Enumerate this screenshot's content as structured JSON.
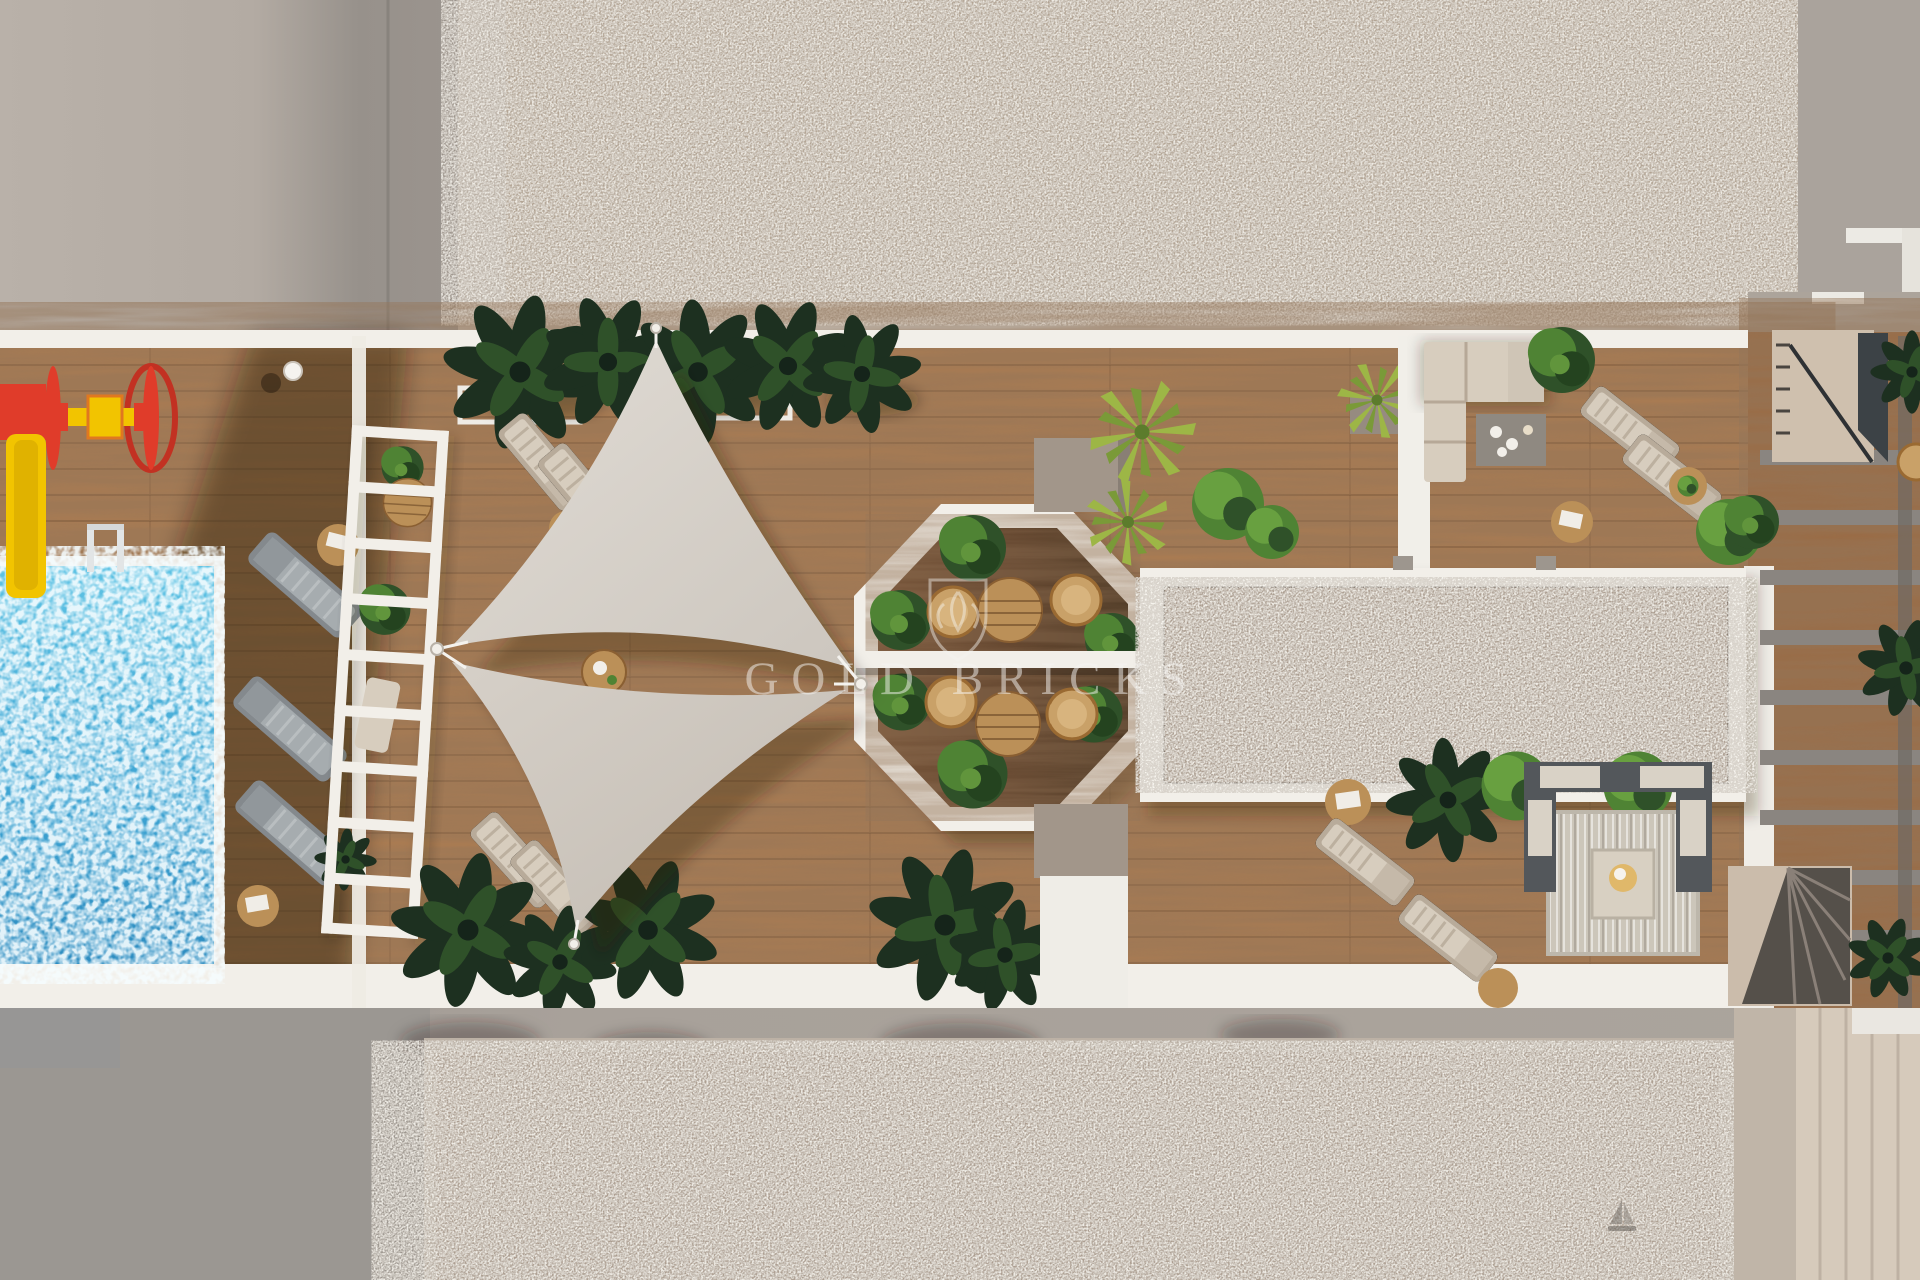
{
  "meta": {
    "type": "architectural-3d-render",
    "view": "top-down aerial plan of a rooftop terrace with pool"
  },
  "watermark": {
    "text": "GOLD BRICKS",
    "logo": "gold-bricks-monogram"
  },
  "palette": {
    "concrete_light": "#b7afa7",
    "concrete_shadow": "#96908a",
    "concrete_frame": "#bfb5aa",
    "gravel_top": "#b7a897",
    "gravel_bottom": "#afa093",
    "gravel_frame": "#bcb1a5",
    "white": "#f2efe9",
    "wood_light": "#ab7c52",
    "wood_mid": "#9a6b44",
    "wood_shadow": "#3f2c1b",
    "octagon_wood": "#6a4830",
    "octagon_wood_dark": "#3a2917",
    "pool_light": "#5fc3e4",
    "pool_deep": "#2d8cc0",
    "sail_light": "#dcd7d0",
    "sail_dark": "#c9c2b9",
    "plant_dark": "#1d3020",
    "plant_mid": "#2f5129",
    "plant_bright": "#4f8334",
    "plant_yellow": "#9db646",
    "taupe": "#a2968a",
    "lounger_gray": "#a6acaf",
    "lounger_beige": "#d7cdbe",
    "rattan": "#c9a168",
    "wood_table": "#bb9058",
    "play_red": "#e03c2a",
    "play_yellow": "#f2c400",
    "rug": "#ccc6ba",
    "sofa_frame": "#53575b",
    "cream_streak": "#d6cabb",
    "watermark": "#f7f6f4"
  },
  "scene": {
    "objects": [
      "swimming-pool",
      "pool-ladder",
      "kids-spinner-toy",
      "kids-slide",
      "lamp-post",
      "gray-sun-loungers",
      "side-tables",
      "white-pergola",
      "shade-sails",
      "sail-poles",
      "octagonal-gazebo",
      "bistro-tables",
      "rattan-chairs",
      "tropical-planters",
      "yucca-plants",
      "round-hedges",
      "outdoor-corner-sofa",
      "coffee-table",
      "gravel-skylight",
      "beige-sun-loungers",
      "lounge-rug-set",
      "stair-landing",
      "spiral-stairwell",
      "slatted-roof-beams",
      "concrete-roof",
      "gravel-border",
      "watermark"
    ]
  }
}
